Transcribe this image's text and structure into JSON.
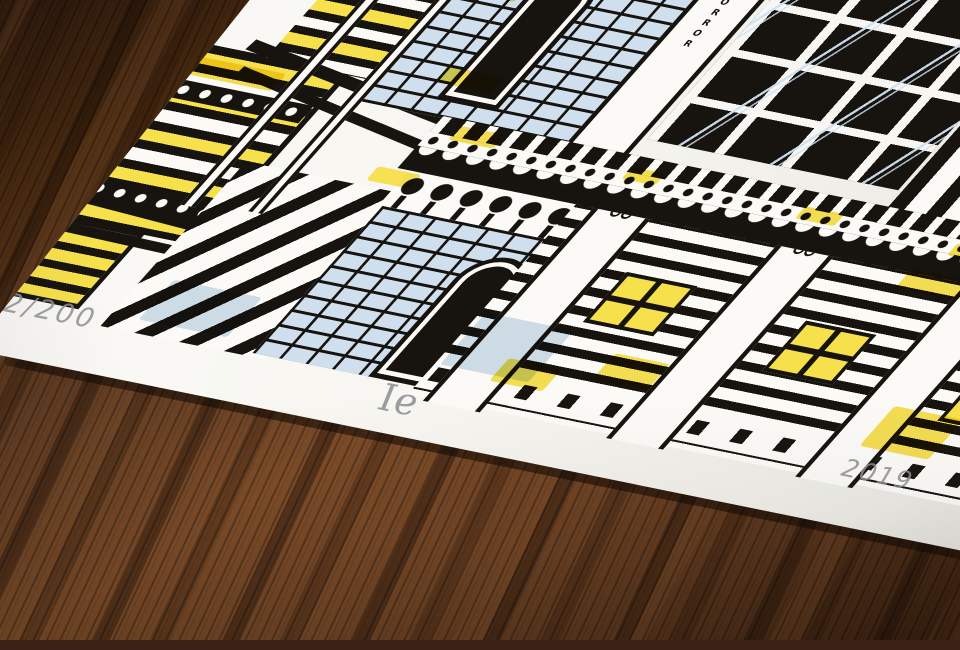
{
  "scene": {
    "subject": "Limited edition architectural art print photographed on a dark wooden table",
    "style": "black ink line illustration with yellow and pale blue watercolour accents"
  },
  "print": {
    "edition_number": "2/200",
    "signature_monogram": "Ie",
    "year": "2019",
    "vertical_sign": "HORROR"
  },
  "colors": {
    "wood_dark": "#2a180d",
    "wood_mid": "#6b4123",
    "wood_light": "#855231",
    "paper": "#f7f6f1",
    "ink": "#17130e",
    "accent_yellow": "#f6e04b",
    "wash_blue": "#cfdfee",
    "pencil_gray": "#8d8d92"
  }
}
